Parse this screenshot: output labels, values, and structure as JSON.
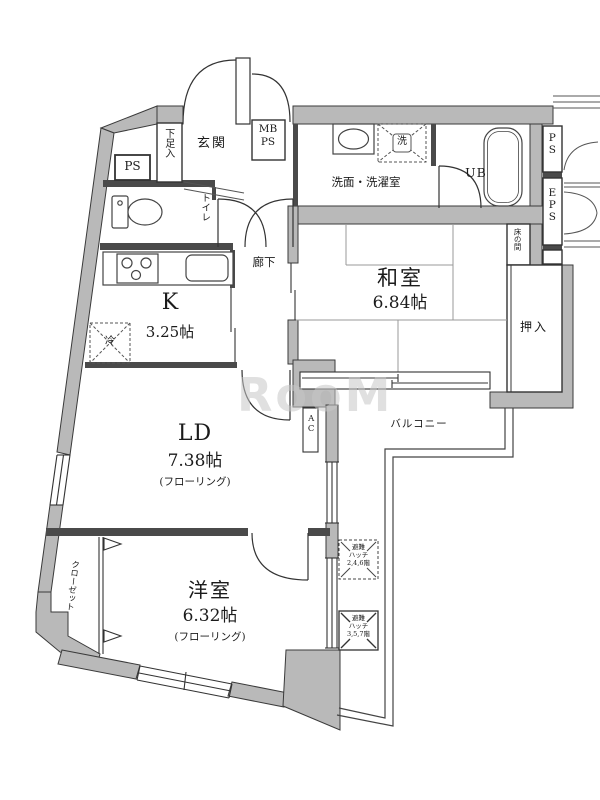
{
  "floorplan": {
    "watermark": "RooM",
    "colors": {
      "wall_fill": "#b9b9b9",
      "wall_stroke": "#3a3a3a",
      "interior_wall": "#4a4a4a",
      "line": "#333333",
      "tatami_line": "#999999"
    },
    "rooms": {
      "entrance": {
        "label": "玄関"
      },
      "shoe_cabinet": {
        "label": "下足入"
      },
      "pipe_space_entrance": {
        "label": "PS"
      },
      "meter_box": {
        "line1": "MB",
        "line2": "PS"
      },
      "washroom": {
        "label": "洗面・洗濯室",
        "washer_symbol": "洗"
      },
      "unit_bath": {
        "label": "UB"
      },
      "pipe_space_right": {
        "label": "PS"
      },
      "electric_pipe_space": {
        "label": "EPS"
      },
      "toilet": {
        "label": "トイレ"
      },
      "corridor": {
        "label": "廊下"
      },
      "kitchen": {
        "label": "K",
        "size": "3.25帖",
        "refrigerator": "冷"
      },
      "japanese_room": {
        "label": "和室",
        "size": "6.84帖",
        "tokonoma": "床の間",
        "oshiire": "押入"
      },
      "living_dining": {
        "label": "LD",
        "size": "7.38帖",
        "flooring": "(フローリング)",
        "ac": "AC"
      },
      "western_room": {
        "label": "洋室",
        "size": "6.32帖",
        "flooring": "(フローリング)",
        "closet": "クローゼット"
      },
      "balcony": {
        "label": "バルコニー",
        "hatch_upper": {
          "line1": "避難",
          "line2": "ハッチ",
          "line3": "2,4,6階"
        },
        "hatch_lower": {
          "line1": "避難",
          "line2": "ハッチ",
          "line3": "3,5,7階"
        }
      }
    }
  }
}
